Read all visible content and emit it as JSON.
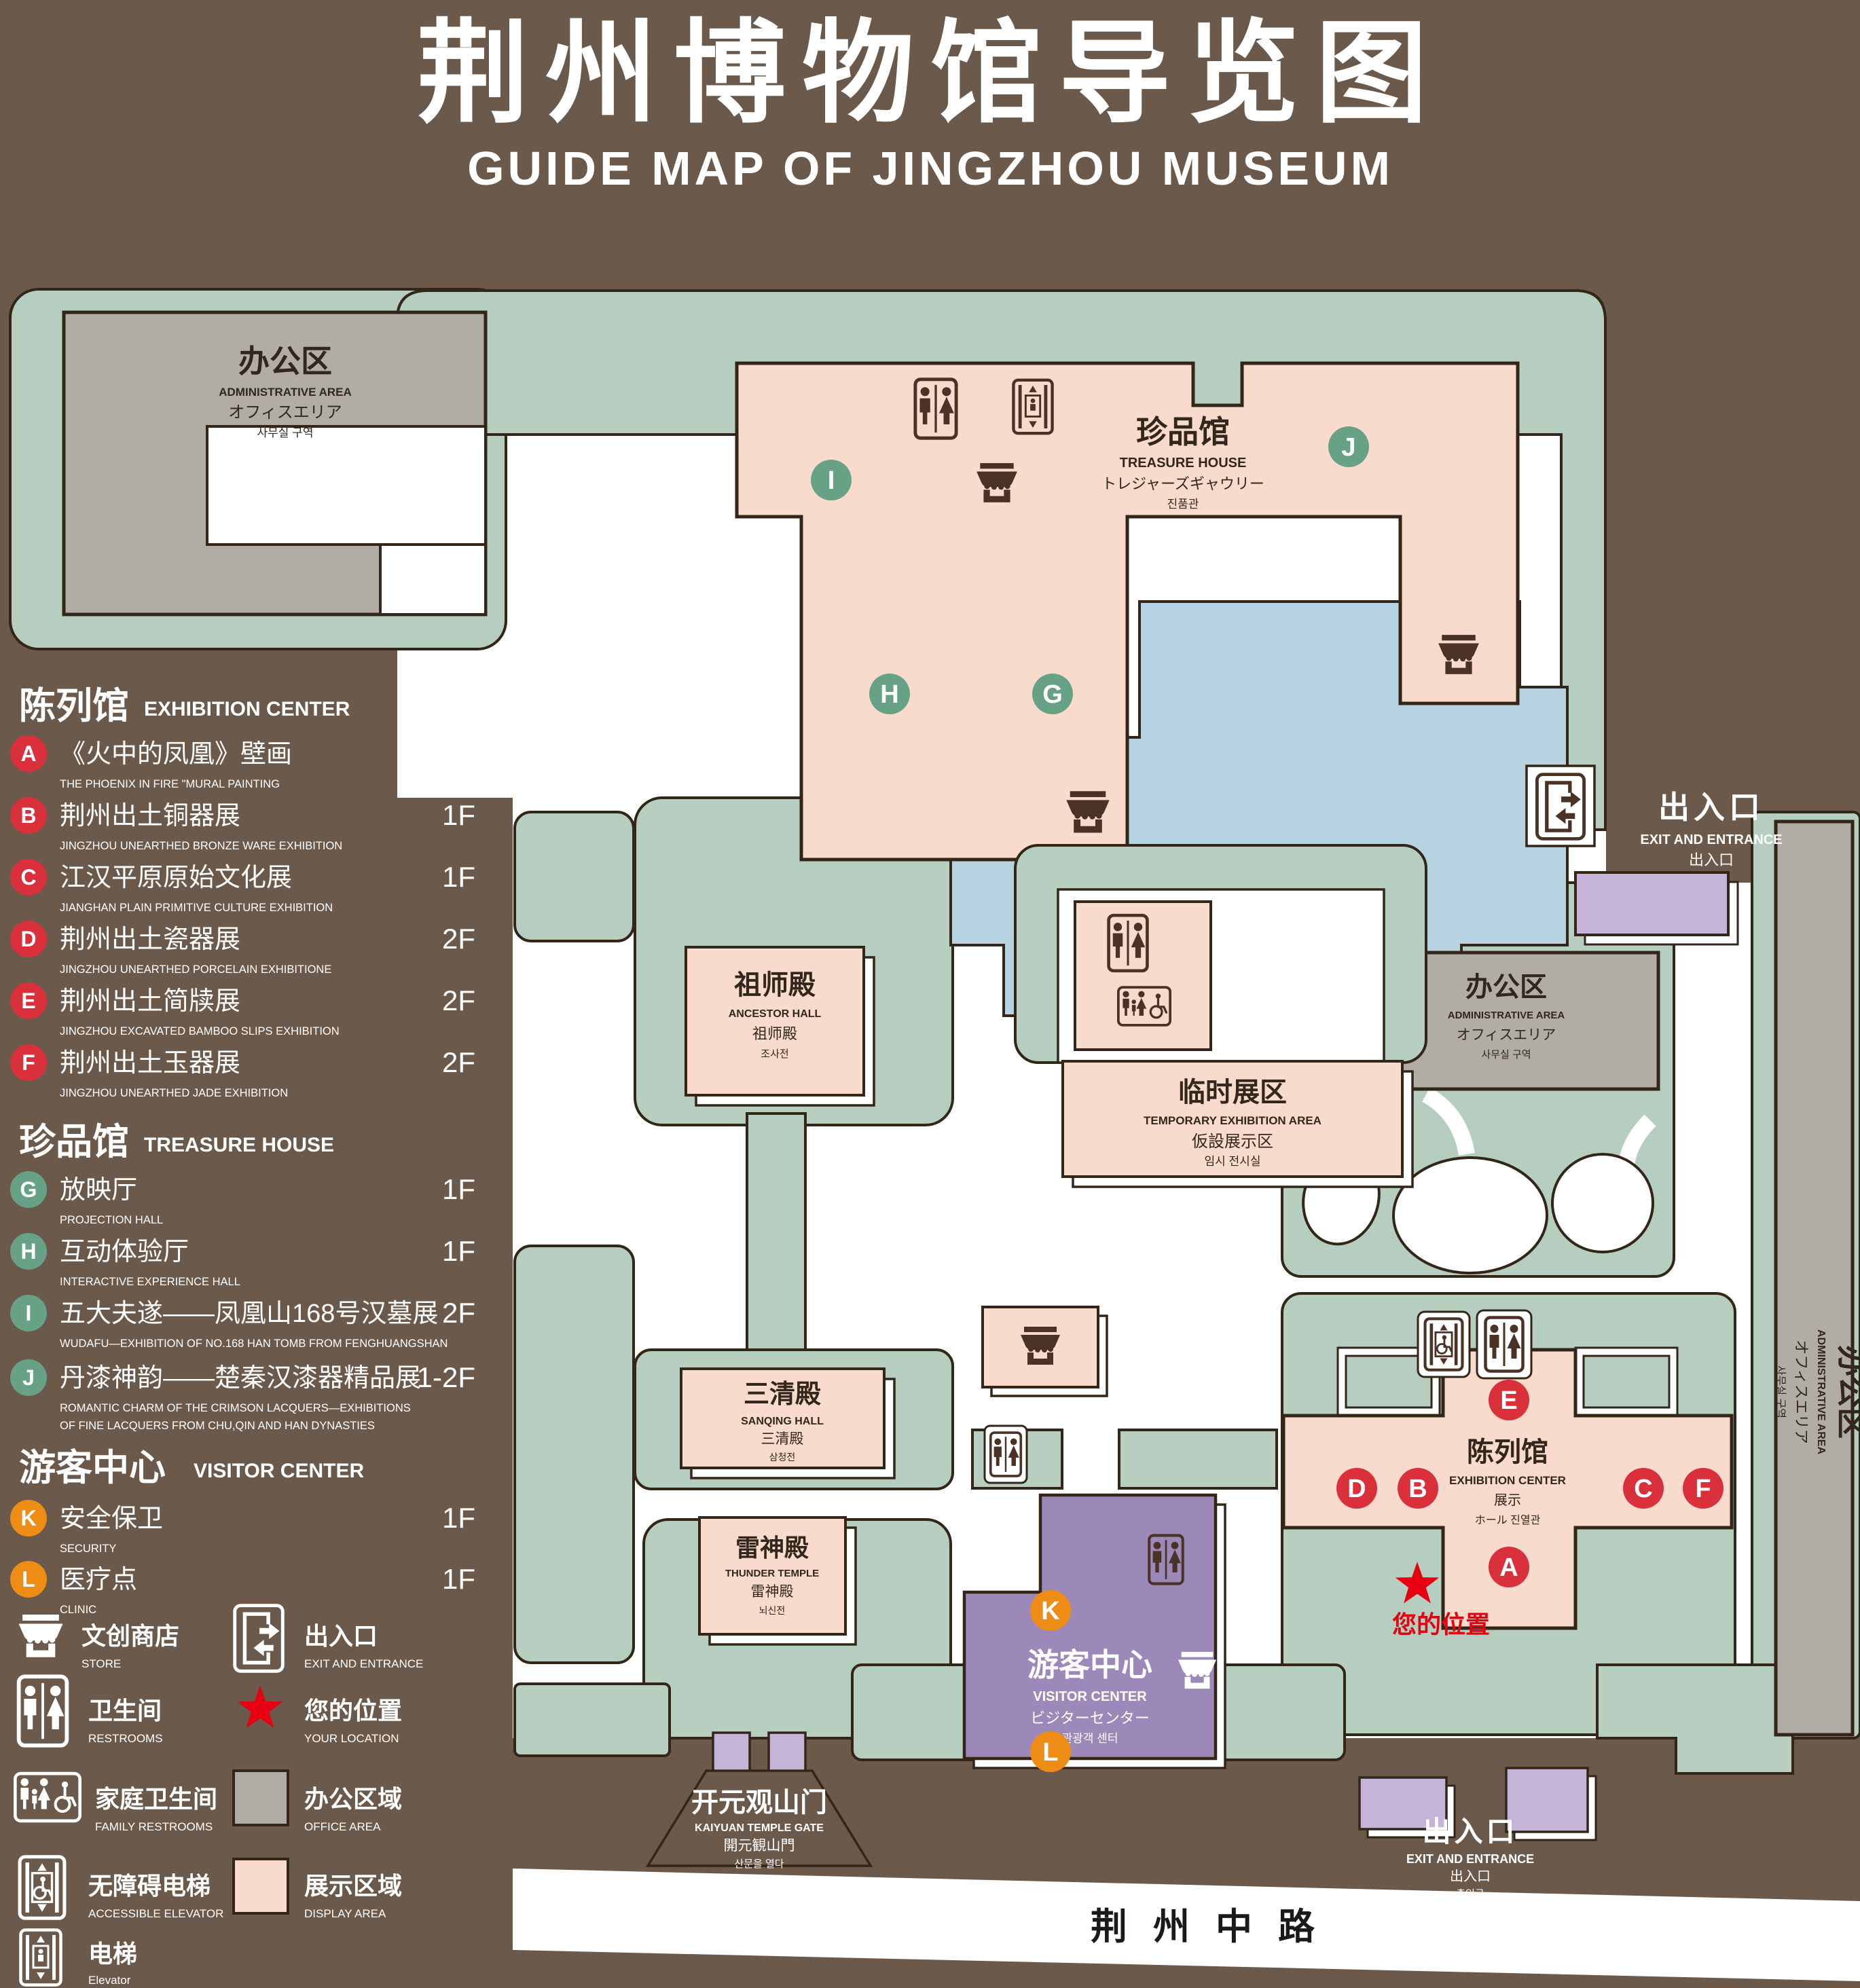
{
  "title": {
    "zh": "荆州博物馆导览图",
    "en": "GUIDE MAP OF JINGZHOU MUSEUM"
  },
  "colors": {
    "bg": "#6b594b",
    "green": "#b5cec0",
    "pink": "#f9dbcd",
    "gray": "#b2aca7",
    "blue": "#b7d2e0",
    "purple": "#9c89ba",
    "purple_light": "#c5b3d8",
    "red_marker": "#d9303c",
    "green_marker": "#67a287",
    "orange_marker": "#ee8d15",
    "outline": "#332619",
    "icon_dark": "#4a3227",
    "star_red": "#e60012",
    "white": "#ffffff",
    "road_text": "#1a1a1a"
  },
  "legend": {
    "sections": [
      {
        "zh": "陈列馆",
        "en": "EXHIBITION CENTER",
        "items": [
          {
            "letter": "A",
            "zh": "《火中的凤凰》壁画",
            "en": "THE PHOENIX IN FIRE \"MURAL PAINTING",
            "floor": "1F"
          },
          {
            "letter": "B",
            "zh": "荆州出土铜器展",
            "en": "JINGZHOU UNEARTHED BRONZE WARE EXHIBITION",
            "floor": "1F"
          },
          {
            "letter": "C",
            "zh": "江汉平原原始文化展",
            "en": "JIANGHAN PLAIN PRIMITIVE CULTURE EXHIBITION",
            "floor": "1F"
          },
          {
            "letter": "D",
            "zh": "荆州出土瓷器展",
            "en": "JINGZHOU UNEARTHED PORCELAIN EXHIBITIONE",
            "floor": "2F"
          },
          {
            "letter": "E",
            "zh": "荆州出土简牍展",
            "en": "JINGZHOU EXCAVATED BAMBOO SLIPS EXHIBITION",
            "floor": "2F"
          },
          {
            "letter": "F",
            "zh": "荆州出土玉器展",
            "en": "JINGZHOU UNEARTHED JADE EXHIBITION",
            "floor": "2F"
          }
        ]
      },
      {
        "zh": "珍品馆",
        "en": "TREASURE HOUSE",
        "items": [
          {
            "letter": "G",
            "zh": "放映厅",
            "en": "PROJECTION HALL",
            "floor": "1F"
          },
          {
            "letter": "H",
            "zh": "互动体验厅",
            "en": "INTERACTIVE EXPERIENCE HALL",
            "floor": "1F"
          },
          {
            "letter": "I",
            "zh": "五大夫遂——凤凰山168号汉墓展",
            "en": "WUDAFU—EXHIBITION OF NO.168 HAN TOMB FROM FENGHUANGSHAN",
            "floor": "2F"
          },
          {
            "letter": "J",
            "zh": "丹漆神韵——楚秦汉漆器精品展",
            "en": "ROMANTIC CHARM OF THE CRIMSON LACQUERS—EXHIBITIONS",
            "en2": "OF FINE LACQUERS FROM CHU,QIN AND HAN DYNASTIES",
            "floor": "1-2F"
          }
        ]
      },
      {
        "zh": "游客中心",
        "en": "VISITOR CENTER",
        "items": [
          {
            "letter": "K",
            "zh": "安全保卫",
            "en": "SECURITY",
            "floor": "1F"
          },
          {
            "letter": "L",
            "zh": "医疗点",
            "en": "CLINIC",
            "floor": "1F"
          }
        ]
      }
    ],
    "icons": {
      "store": {
        "zh": "文创商店",
        "en": "STORE"
      },
      "exit": {
        "zh": "出入口",
        "en": "EXIT AND ENTRANCE"
      },
      "restrooms": {
        "zh": "卫生间",
        "en": "RESTROOMS"
      },
      "location": {
        "zh": "您的位置",
        "en": "YOUR LOCATION"
      },
      "family": {
        "zh": "家庭卫生间",
        "en": "FAMILY RESTROOMS"
      },
      "office": {
        "zh": "办公区域",
        "en": "OFFICE AREA"
      },
      "accessible": {
        "zh": "无障碍电梯",
        "en": "ACCESSIBLE ELEVATOR"
      },
      "display": {
        "zh": "展示区域",
        "en": "DISPLAY AREA"
      },
      "elevator": {
        "zh": "电梯",
        "en": "Elevator"
      }
    }
  },
  "map": {
    "admin": {
      "zh": "办公区",
      "en": "ADMINISTRATIVE AREA",
      "ja": "オフィスエリア",
      "ko": "사무실 구역"
    },
    "treasure_house": {
      "zh": "珍品馆",
      "en": "TREASURE HOUSE",
      "ja": "トレジャーズギャウリー",
      "ko": "진품관"
    },
    "ancestor_hall": {
      "zh": "祖师殿",
      "en": "ANCESTOR HALL",
      "ja": "祖师殿",
      "ko": "조사전"
    },
    "temporary": {
      "zh": "临时展区",
      "en": "TEMPORARY EXHIBITION AREA",
      "ja": "仮設展示区",
      "ko": "임시 전시실"
    },
    "sanqing_hall": {
      "zh": "三清殿",
      "en": "SANQING HALL",
      "ja": "三清殿",
      "ko": "삼청전"
    },
    "thunder_temple": {
      "zh": "雷神殿",
      "en": "THUNDER TEMPLE",
      "ja": "雷神殿",
      "ko": "뇌신전"
    },
    "visitor_center": {
      "zh": "游客中心",
      "en": "VISITOR CENTER",
      "ja": "ビジターセンター",
      "ko": "관광객 센터"
    },
    "exhibition_center": {
      "zh": "陈列馆",
      "en": "EXHIBITION CENTER",
      "ja": "展示",
      "line4": "ホール 진열관"
    },
    "exit": {
      "zh": "出入口",
      "en": "EXIT AND ENTRANCE",
      "zh_small": "出入口",
      "ko": "출입구"
    },
    "gate": {
      "zh": "开元观山门",
      "en": "KAIYUAN TEMPLE GATE",
      "ja": "開元観山門",
      "ko": "산문을 열다"
    },
    "road": {
      "zh": "荆州中路"
    },
    "your_location": {
      "zh": "您的位置"
    }
  }
}
